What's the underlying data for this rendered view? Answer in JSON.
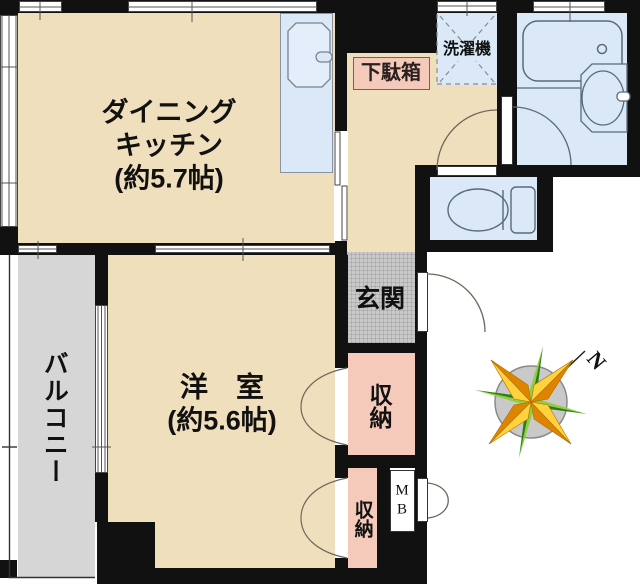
{
  "plan": {
    "dining_kitchen": {
      "line1": "ダイニング",
      "line2": "キッチン",
      "size": "(約5.7帖)"
    },
    "western_room": {
      "name": "洋　室",
      "size": "(約5.6帖)"
    },
    "balcony": {
      "name": "バルコニー"
    },
    "entrance": {
      "name": "玄関"
    },
    "storage_upper": {
      "name": "収納"
    },
    "storage_lower": {
      "name": "収納"
    },
    "shoe_cabinet": {
      "name": "下駄箱"
    },
    "washing_machine": {
      "name": "洗濯機"
    },
    "meter_box": {
      "line1": "M",
      "line2": "B"
    },
    "compass": {
      "north_label": "N"
    }
  },
  "colors": {
    "wall": "#111111",
    "room_beige": "#f0dfbc",
    "water_blue": "#dbe8f7",
    "storage_pink": "#f5cabb",
    "balcony_gray": "#d6d6d6",
    "entrance_gray": "#c9c9c9",
    "compass_orange": "#dd8500",
    "compass_yellow": "#ffd23e",
    "compass_green": "#2f7d12"
  }
}
